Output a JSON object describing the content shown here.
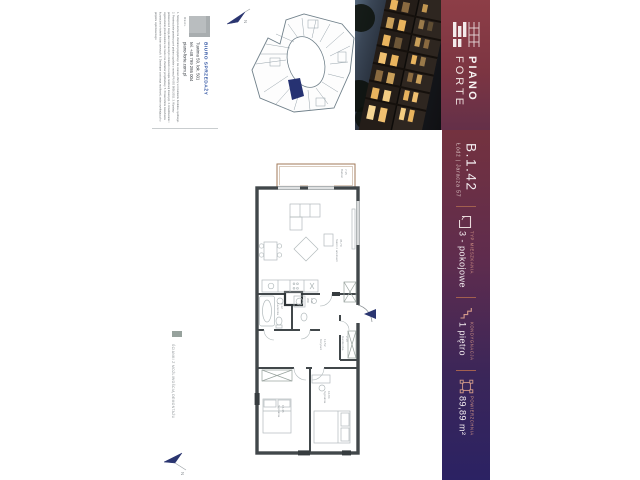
{
  "brand": {
    "line1": "PIANO",
    "line2": "FORTE"
  },
  "sidebar": {
    "unit_id": "B.1.42",
    "location": "Łódź  |  Jaracza 57",
    "attributes": [
      {
        "icon": "door-plan-icon",
        "label": "TYP MIESZKANIA",
        "value": "3 - pokojowe"
      },
      {
        "icon": "stairs-icon",
        "label": "KONDYGNACJA",
        "value": "1 piętro"
      },
      {
        "icon": "area-icon",
        "label": "POWIERZCHNIA",
        "value": "89,89 m²"
      }
    ]
  },
  "sales_info": {
    "developer": "REAL",
    "office_label": "BIURO SPRZEDAŻY",
    "address": "Tuwima 59, lok. 501",
    "phone": "tel. +48 799 286 004",
    "website": "piano-forte.com.pl",
    "disclaimers": [
      "1. Niniejsza karta ma charakter poglądowy i nie stanowi oferty w rozumieniu Kodeksu cywilnego.",
      "2. Powierzchnie pomieszczeń podano zgodnie z normą PN-ISO 9836:2015.",
      "3. Wymiary pomieszczeń mogą ulec nieznacznym zmianom na etapie realizacji inwestycji.",
      "4. Umeblowanie i wyposażenie przedstawione na rzucie ma charakter przykładowy.",
      "5. Powierzchnia mieszkania liczona jest w świetle ścian surowych.",
      "6. Deweloper zastrzega możliwość zmian wynikających z projektu wykonawczego."
    ]
  },
  "site_plan": {
    "compass_label": "N"
  },
  "floor_plan": {
    "compass_label": "N",
    "legend_label": "ŚCIANKI Z MOŻLIWOŚCIĄ DEMONTAŻU",
    "rooms": [
      {
        "area": "7.35",
        "name": "Balkon"
      },
      {
        "area": "35.70",
        "name": "Salon z aneksem"
      },
      {
        "area": "5.12",
        "name": "Łazienka"
      },
      {
        "area": "2.11",
        "name": "WC"
      },
      {
        "area": "13.52",
        "name": "Korytarz"
      },
      {
        "area": "2.38",
        "name": "Garderoba"
      },
      {
        "area": "15.45",
        "name": "Sypialnia"
      },
      {
        "area": "10.84",
        "name": "Sypialnia"
      }
    ]
  },
  "colors": {
    "accent_salmon": "#d29486",
    "sidebar_top": "#74323f",
    "sidebar_bottom": "#2b2263",
    "highlight_navy": "#263272",
    "office_blue": "#2a4fa0",
    "legend_gray": "#97a29d"
  }
}
